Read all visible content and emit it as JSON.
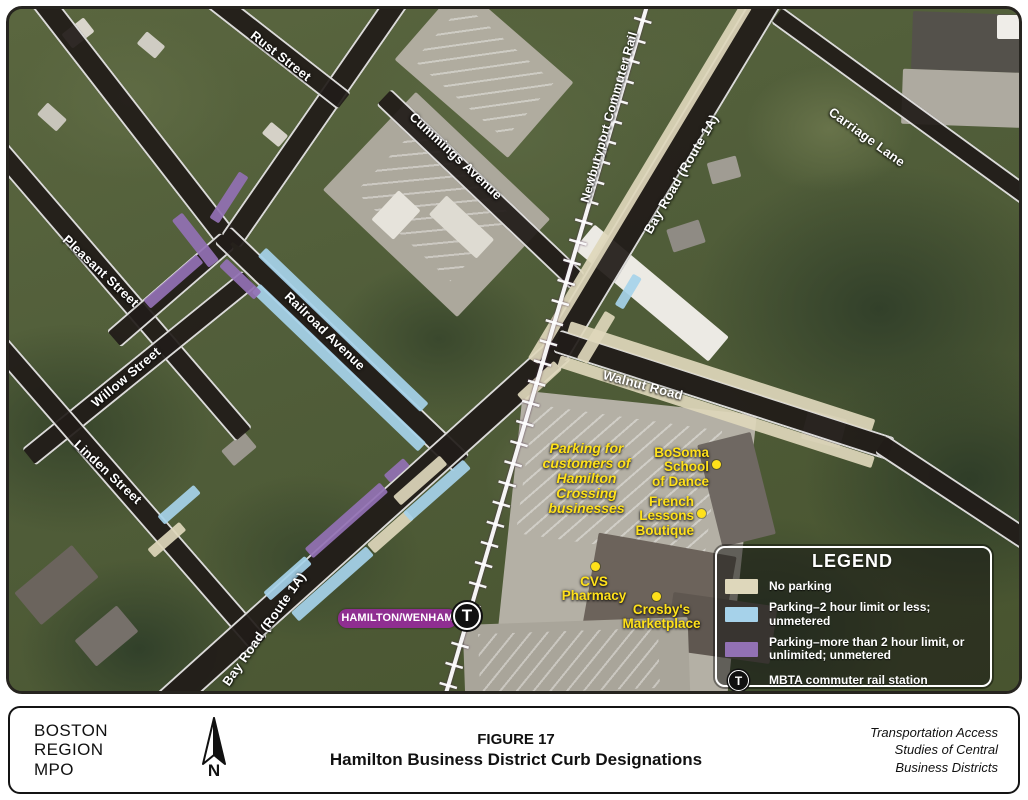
{
  "theme": {
    "no_parking_beige": "#ded7bb",
    "parking_2hr_blue": "#a6d2ea",
    "parking_over2hr_purple": "#9271b4",
    "station_magenta": "#8f2e91",
    "poi_yellow": "#ffe11a",
    "road_dark": "#211c19"
  },
  "map": {
    "street_labels": [
      {
        "id": "rust-street",
        "text": "Rust Street"
      },
      {
        "id": "cummings-avenue",
        "text": "Cummings Avenue"
      },
      {
        "id": "pleasant-street",
        "text": "Pleasant Street"
      },
      {
        "id": "willow-street",
        "text": "Willow Street"
      },
      {
        "id": "linden-street",
        "text": "Linden Street"
      },
      {
        "id": "railroad-avenue",
        "text": "Railroad Avenue"
      },
      {
        "id": "bay-road-north",
        "text": "Bay Road (Route 1A)"
      },
      {
        "id": "walnut-road",
        "text": "Walnut Road"
      },
      {
        "id": "carriage-lane",
        "text": "Carriage Lane"
      },
      {
        "id": "bay-road-south",
        "text": "Bay Road (Route 1A)"
      },
      {
        "id": "newburyport-commuter-rail",
        "text": "Newburyport Commuter Rail"
      }
    ],
    "pois": {
      "parking_note": {
        "text": "Parking for\ncustomers of\nHamilton\nCrossing\nbusinesses"
      },
      "bosoma": {
        "text": "BoSoma\nSchool\nof Dance"
      },
      "french": {
        "text": "French\nLessons\nBoutique"
      },
      "cvs": {
        "text": "CVS\nPharmacy"
      },
      "crosby": {
        "text": "Crosby's\nMarketplace"
      }
    },
    "station": {
      "badge": "HAMILTON/WENHAM",
      "symbol": "T"
    },
    "legend": {
      "title": "LEGEND",
      "items": [
        {
          "key": "no_parking",
          "label": "No parking"
        },
        {
          "key": "parking_2hr",
          "label": "Parking–2 hour limit or less; unmetered"
        },
        {
          "key": "parking_over_2hr",
          "label": "Parking–more than 2 hour limit, or\nunlimited; unmetered"
        },
        {
          "key": "station",
          "label": "MBTA commuter rail station"
        }
      ]
    }
  },
  "footer": {
    "org": "BOSTON\nREGION\nMPO",
    "north_label": "N",
    "figure_label": "FIGURE 17",
    "figure_title": "Hamilton Business District Curb Designations",
    "credit": "Transportation Access\nStudies of Central\nBusiness Districts"
  }
}
